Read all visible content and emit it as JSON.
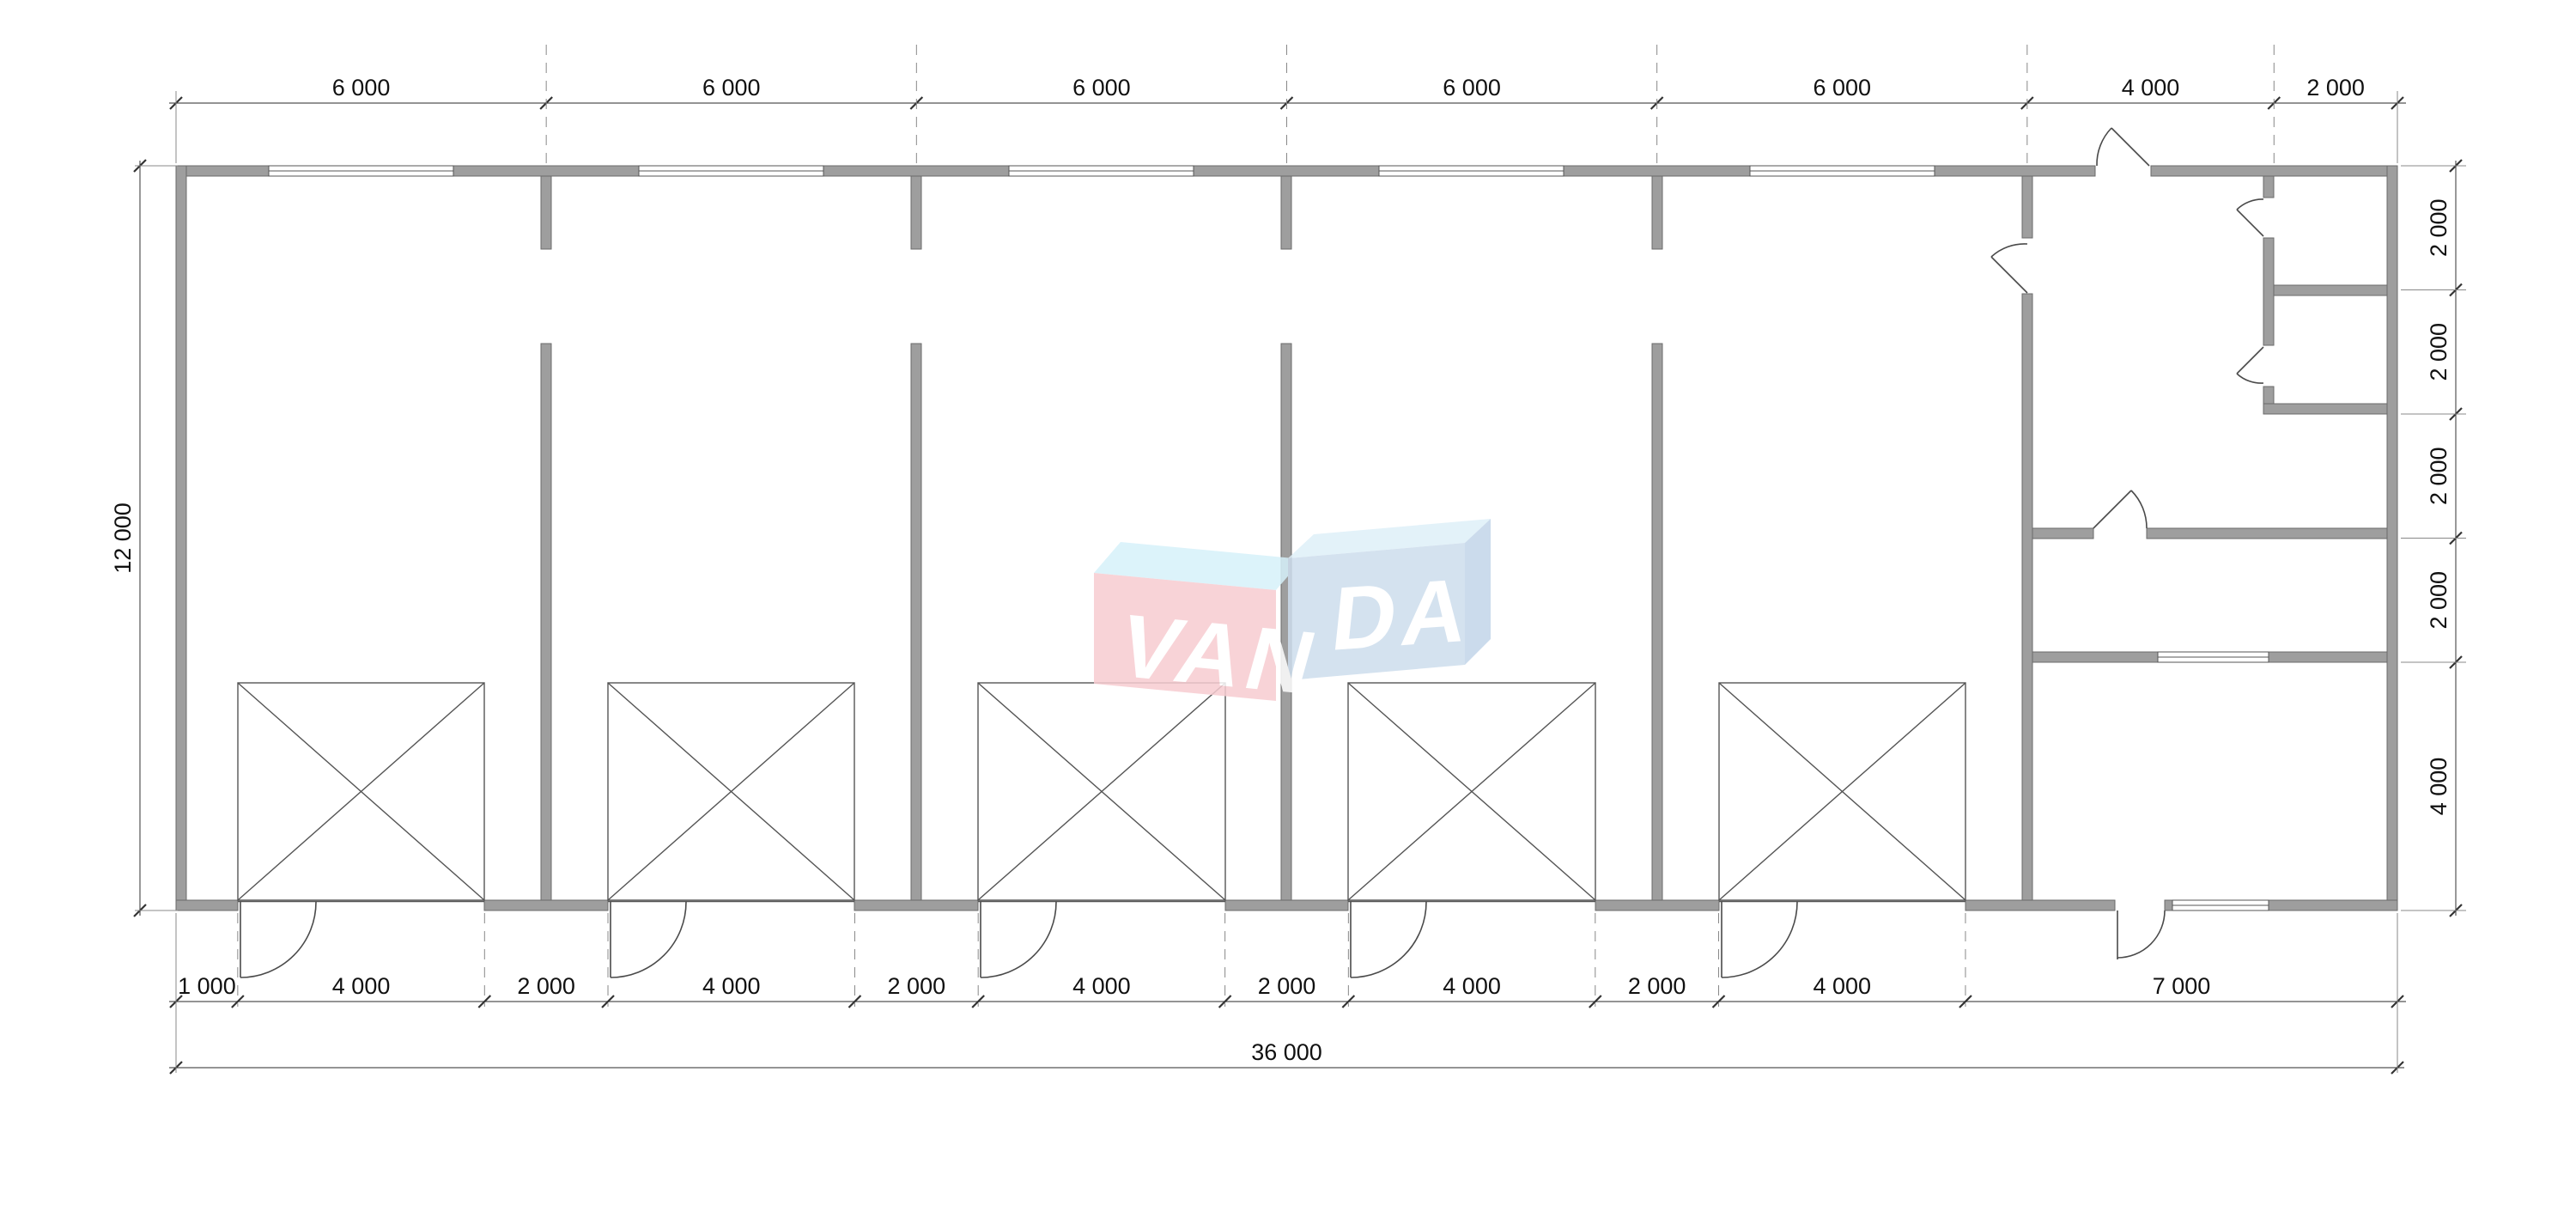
{
  "plan": {
    "total_width_mm": 36000,
    "total_height_mm": 12000,
    "garage_bays": 5,
    "top_windows": 5,
    "garage_door_openings": 5
  },
  "dims": {
    "top": {
      "labels": [
        "6 000",
        "6 000",
        "6 000",
        "6 000",
        "6 000",
        "4 000",
        "2 000"
      ],
      "mm": [
        6000,
        6000,
        6000,
        6000,
        6000,
        4000,
        2000
      ]
    },
    "bottom": {
      "labels": [
        "1 000",
        "4 000",
        "2 000",
        "4 000",
        "2 000",
        "4 000",
        "2 000",
        "4 000",
        "2 000",
        "4 000",
        "7 000"
      ],
      "mm": [
        1000,
        4000,
        2000,
        4000,
        2000,
        4000,
        2000,
        4000,
        2000,
        4000,
        7000
      ]
    },
    "right": {
      "labels": [
        "2 000",
        "2 000",
        "2 000",
        "2 000",
        "4 000"
      ],
      "mm": [
        2000,
        2000,
        2000,
        2000,
        4000
      ]
    },
    "left": {
      "label": "12 000",
      "mm": 12000
    },
    "total": {
      "label": "36 000",
      "mm": 36000
    }
  },
  "watermark": {
    "text_left": "VAN",
    "text_right": "DA",
    "pink": "#f7ccd1",
    "cyan_top": "#d6f1fa",
    "blue": "#cddded",
    "blue_top": "#dff0f9",
    "blue_side": "#c3d5e9",
    "letter_color": "#ffffff"
  },
  "colors": {
    "wall": "#9e9e9e",
    "wall_outline": "#6b6b6b",
    "dim_line": "#555555",
    "extension_line": "#888888",
    "tick": "#333333",
    "text": "#111111",
    "background": "#ffffff"
  }
}
